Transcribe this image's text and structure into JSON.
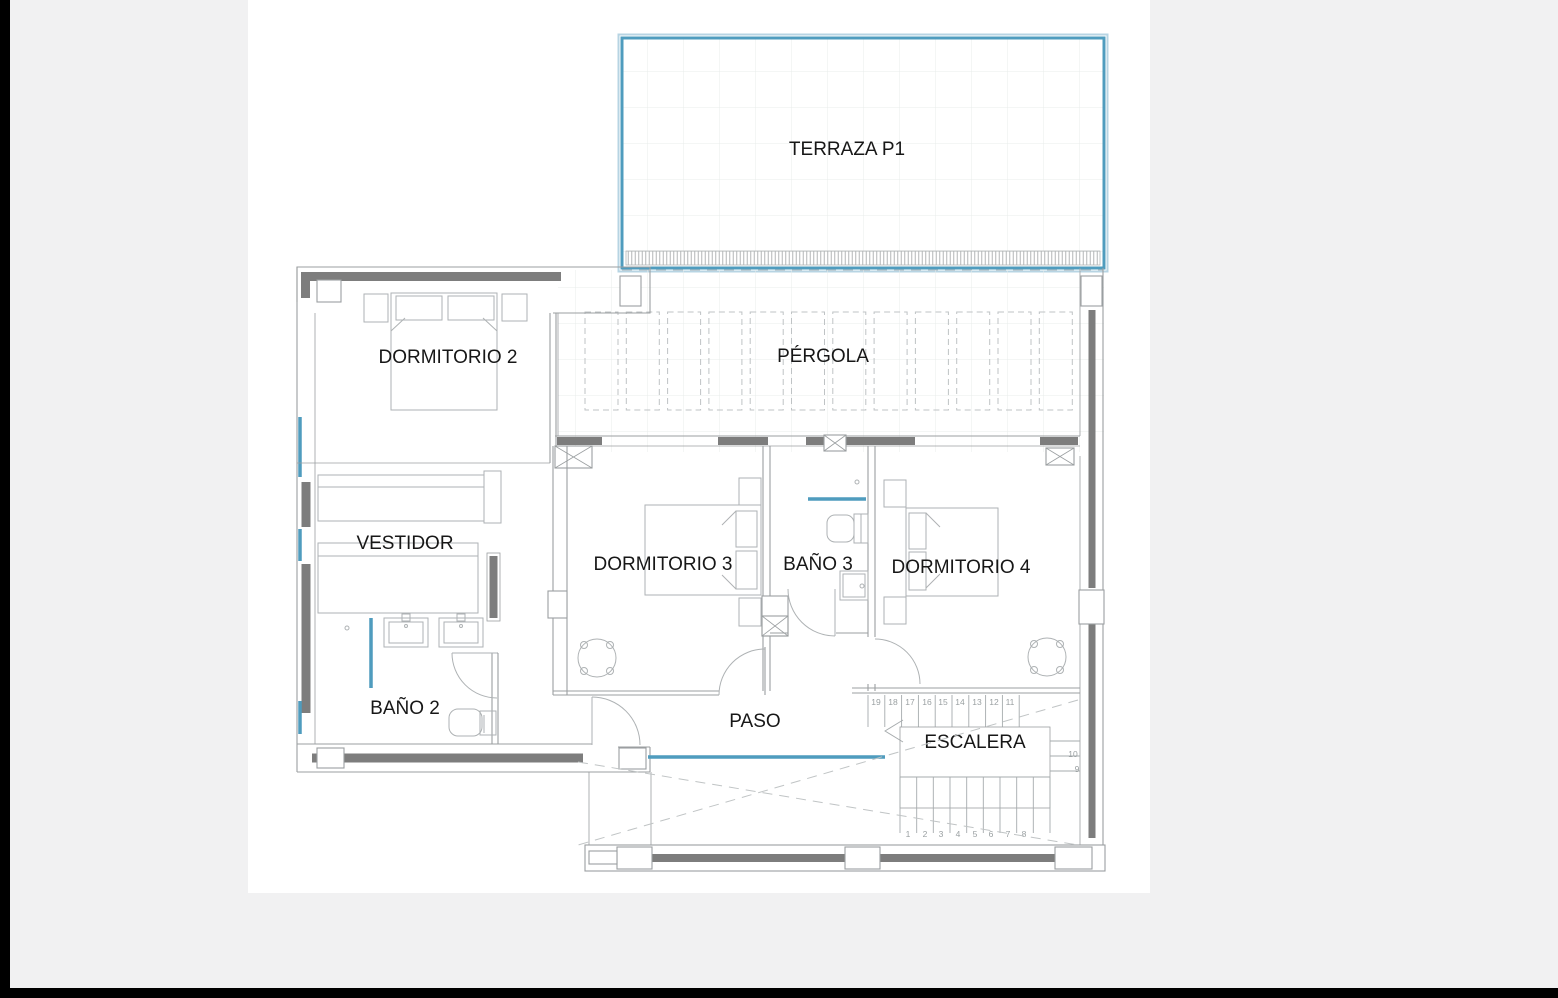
{
  "meta": {
    "drawing_type": "architectural floor plan",
    "floor_tag": "P1"
  },
  "colors": {
    "accent_blue": "#4f9cbe",
    "accent_blue_light": "#b7d4e3",
    "wall_gray": "#7d7d7d",
    "line_gray": "#9b9fa1",
    "page_bg": "#f1f1f2",
    "canvas_bg": "#ffffff",
    "edge_bar": "#000000"
  },
  "rooms": {
    "terraza": "TERRAZA P1",
    "dormitorio2": "DORMITORIO 2",
    "pergola": "PÉRGOLA",
    "vestidor": "VESTIDOR",
    "dormitorio3": "DORMITORIO 3",
    "bano3": "BAÑO 3",
    "dormitorio4": "DORMITORIO 4",
    "bano2": "BAÑO 2",
    "paso": "PASO",
    "escalera": "ESCALERA"
  },
  "stairs": {
    "upper_run": [
      "19",
      "18",
      "17",
      "16",
      "15",
      "14",
      "13",
      "12",
      "11"
    ],
    "side_steps": [
      "10",
      "9"
    ],
    "lower_run": [
      "1",
      "2",
      "3",
      "4",
      "5",
      "6",
      "7",
      "8"
    ]
  }
}
